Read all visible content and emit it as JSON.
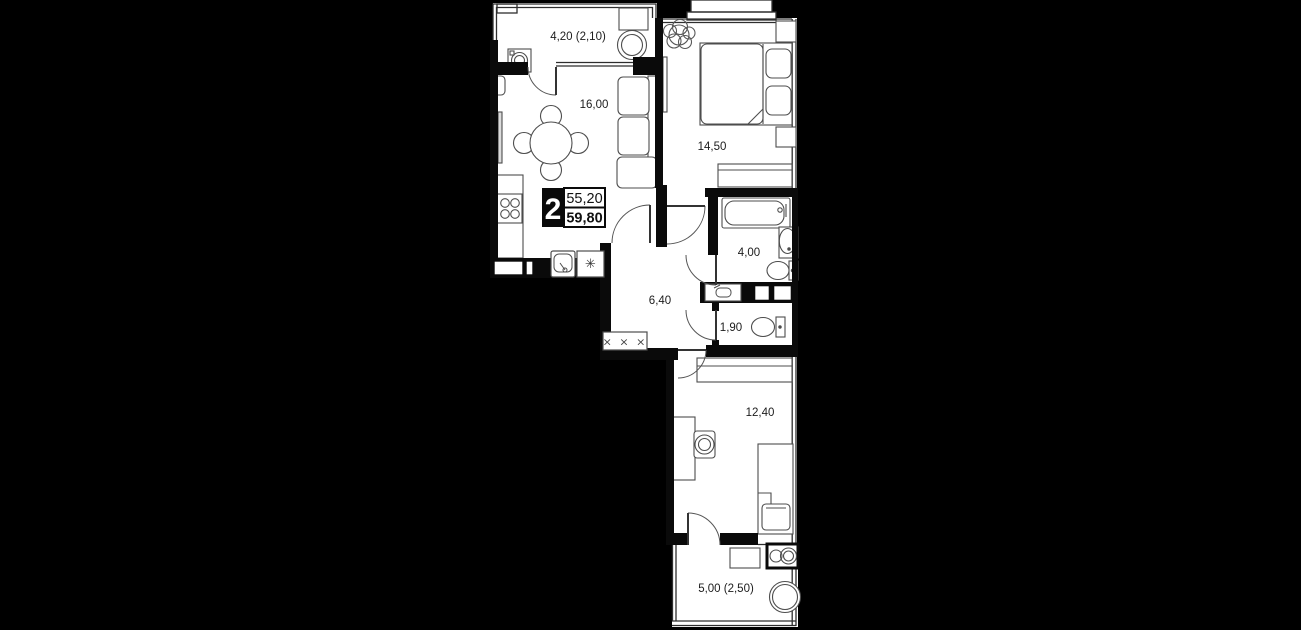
{
  "unit_badge": {
    "rooms_count": "2",
    "area_total": "55,20",
    "area_living": "59,80"
  },
  "rooms": [
    {
      "id": "balcony-top",
      "label": "4,20 (2,10)"
    },
    {
      "id": "kitchen-living",
      "label": "16,00"
    },
    {
      "id": "bedroom",
      "label": "14,50"
    },
    {
      "id": "bathroom",
      "label": "4,00"
    },
    {
      "id": "hallway",
      "label": "6,40"
    },
    {
      "id": "wc",
      "label": "1,90"
    },
    {
      "id": "bedroom-2",
      "label": "12,40"
    },
    {
      "id": "balcony-bottom",
      "label": "5,00 (2,50)"
    }
  ],
  "symbols": {
    "fridge": "✳",
    "coat_rack": "× × ×"
  },
  "colors": {
    "background": "#000000",
    "floor": "#ffffff",
    "walls": "#0a0a0a",
    "furniture_line": "#4d4d4d"
  }
}
